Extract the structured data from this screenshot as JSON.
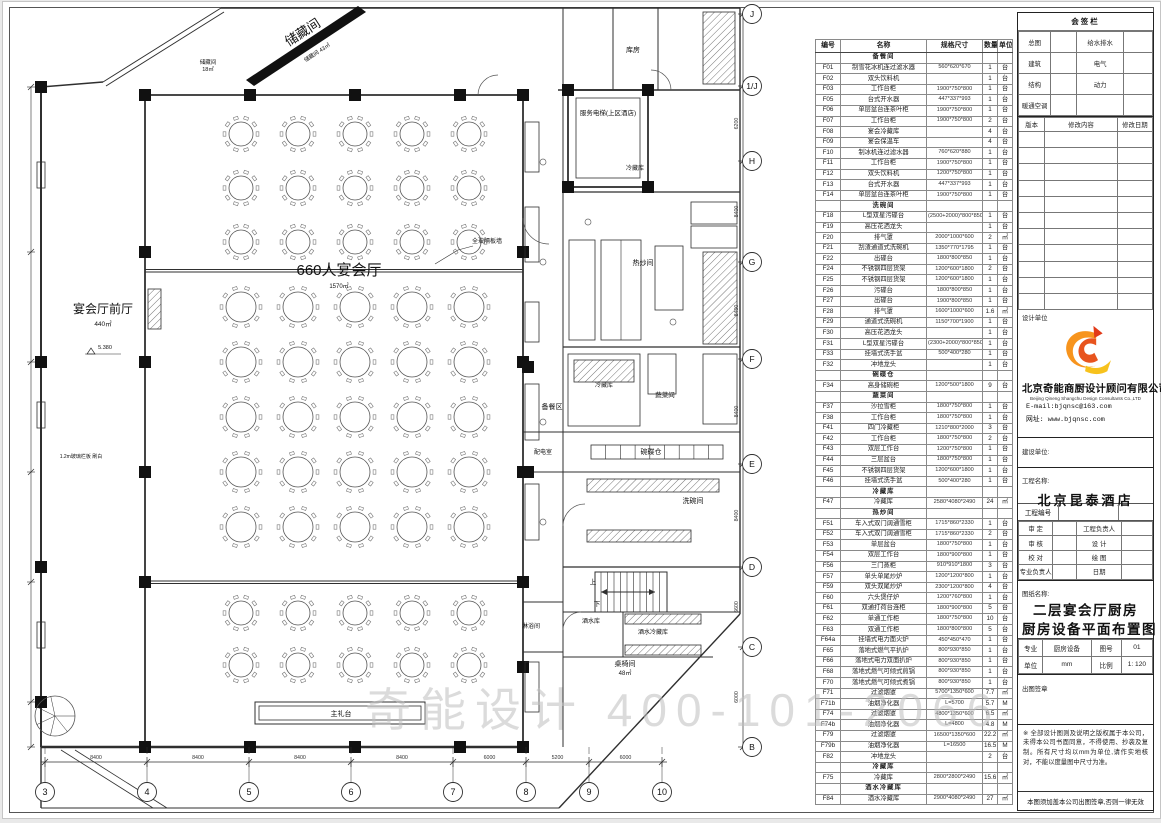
{
  "watermark": "奇能设计 400-101-2066",
  "plan": {
    "room_labels": [
      {
        "t": "宴会厅前厅",
        "x": 100,
        "y": 311,
        "s": 12
      },
      {
        "t": "440㎡",
        "x": 100,
        "y": 324,
        "s": 6.5
      },
      {
        "t": "5.380",
        "x": 102,
        "y": 347,
        "s": 5.5
      },
      {
        "t": "660人宴会厅",
        "x": 336,
        "y": 273,
        "s": 15
      },
      {
        "t": "1570㎡",
        "x": 336,
        "y": 286,
        "s": 6
      },
      {
        "t": "全玻隔板墙",
        "x": 484,
        "y": 241,
        "s": 6
      },
      {
        "t": "储藏间",
        "x": 302,
        "y": 34,
        "s": 13,
        "r": -33
      },
      {
        "t": "储藏间 43㎡",
        "x": 315,
        "y": 52,
        "s": 5.5,
        "r": -33
      },
      {
        "t": "储藏间",
        "x": 205,
        "y": 62,
        "s": 5.5
      },
      {
        "t": "18㎡",
        "x": 205,
        "y": 69,
        "s": 5.5
      },
      {
        "t": "服务电梯(上区酒店)",
        "x": 605,
        "y": 113,
        "s": 6.5
      },
      {
        "t": "库房",
        "x": 630,
        "y": 50,
        "s": 7
      },
      {
        "t": "冷藏库",
        "x": 632,
        "y": 168,
        "s": 6
      },
      {
        "t": "热炒间",
        "x": 640,
        "y": 263,
        "s": 7
      },
      {
        "t": "备餐区",
        "x": 549,
        "y": 407,
        "s": 7
      },
      {
        "t": "冷藏库",
        "x": 601,
        "y": 385,
        "s": 6
      },
      {
        "t": "蔬菜间",
        "x": 662,
        "y": 395,
        "s": 6.5
      },
      {
        "t": "碗碟仓",
        "x": 648,
        "y": 452,
        "s": 7
      },
      {
        "t": "洗碗间",
        "x": 690,
        "y": 501,
        "s": 7
      },
      {
        "t": "配电室",
        "x": 540,
        "y": 452,
        "s": 6
      },
      {
        "t": "淋浴间",
        "x": 528,
        "y": 626,
        "s": 6
      },
      {
        "t": "酒水库",
        "x": 588,
        "y": 621,
        "s": 6
      },
      {
        "t": "酒水冷藏库",
        "x": 650,
        "y": 632,
        "s": 6
      },
      {
        "t": "桌椅间",
        "x": 622,
        "y": 664,
        "s": 7
      },
      {
        "t": "48㎡",
        "x": 622,
        "y": 673,
        "s": 6
      },
      {
        "t": "主礼台",
        "x": 338,
        "y": 714,
        "s": 7
      },
      {
        "t": "上",
        "x": 590,
        "y": 582,
        "s": 6.5
      },
      {
        "t": "下",
        "x": 594,
        "y": 604,
        "s": 6.5
      },
      {
        "t": "1.2m玻璃栏板 刷白",
        "x": 78,
        "y": 456,
        "s": 5
      }
    ],
    "grid_cols": {
      "labels": [
        "3",
        "4",
        "5",
        "6",
        "7",
        "8",
        "9",
        "10"
      ],
      "x": [
        42,
        144,
        246,
        348,
        450,
        523,
        586,
        659
      ],
      "dims": [
        "8400",
        "8400",
        "8400",
        "8400",
        "6000",
        "5200",
        "6000"
      ]
    },
    "grid_rows": {
      "labels": [
        "J",
        "1/J",
        "H",
        "G",
        "F",
        "E",
        "D",
        "C",
        "B"
      ],
      "y": [
        12,
        84,
        159,
        260,
        357,
        462,
        565,
        645,
        745
      ],
      "dims": [
        "",
        "6200",
        "8400",
        "8400",
        "8400",
        "8400",
        "6600",
        "6000"
      ]
    }
  },
  "equipment_table": {
    "headers": [
      "编号",
      "名称",
      "规格尺寸",
      "数量",
      "单位"
    ],
    "rows": [
      {
        "section": "备餐间"
      },
      [
        "F01",
        "制雪花冰机连过滤水器",
        "560*620*670",
        "1",
        "台"
      ],
      [
        "F02",
        "双头饮料机",
        "",
        "1",
        "台"
      ],
      [
        "F03",
        "工作台柜",
        "1900*750*800",
        "1",
        "台"
      ],
      [
        "F05",
        "台式开水器",
        "447*337*993",
        "1",
        "台"
      ],
      [
        "F06",
        "单层盆台连茶叶柜",
        "1900*750*800",
        "1",
        "台"
      ],
      [
        "F07",
        "工作台柜",
        "1900*750*800",
        "2",
        "台"
      ],
      [
        "F08",
        "宴会冷藏库",
        "",
        "4",
        "台"
      ],
      [
        "F09",
        "宴会保温车",
        "",
        "4",
        "台"
      ],
      [
        "F10",
        "制冰机连过滤水器",
        "760*620*880",
        "1",
        "台"
      ],
      [
        "F11",
        "工作台柜",
        "1900*750*800",
        "1",
        "台"
      ],
      [
        "F12",
        "双头饮料机",
        "1200*750*800",
        "1",
        "台"
      ],
      [
        "F13",
        "台式开水器",
        "447*337*993",
        "1",
        "台"
      ],
      [
        "F14",
        "单层盆台连茶叶柜",
        "1900*750*800",
        "1",
        "台"
      ],
      {
        "section": "洗碗间"
      },
      [
        "F18",
        "L型双星污碟台",
        "(2500+2000)*800*850",
        "1",
        "台"
      ],
      [
        "F19",
        "高压花洒龙头",
        "",
        "1",
        "台"
      ],
      [
        "F20",
        "排气罩",
        "2000*1000*600",
        "2",
        "㎡"
      ],
      [
        "F21",
        "刮渣通道式洗碗机",
        "1350*770*1795",
        "1",
        "台"
      ],
      [
        "F22",
        "出碟台",
        "1800*800*850",
        "1",
        "台"
      ],
      [
        "F24",
        "不锈钢四层货架",
        "1200*600*1800",
        "2",
        "台"
      ],
      [
        "F25",
        "不锈钢四层货架",
        "1200*600*1800",
        "1",
        "台"
      ],
      [
        "F26",
        "污碟台",
        "1800*800*850",
        "1",
        "台"
      ],
      [
        "F27",
        "出碟台",
        "1900*800*850",
        "1",
        "台"
      ],
      [
        "F28",
        "排气罩",
        "1600*1000*600",
        "1.6",
        "㎡"
      ],
      [
        "F29",
        "通道式洗碗机",
        "1150*700*1900",
        "1",
        "台"
      ],
      [
        "F30",
        "高压花洒龙头",
        "",
        "1",
        "台"
      ],
      [
        "F31",
        "L型双星污碟台",
        "(2300+2000)*800*850",
        "1",
        "台"
      ],
      [
        "F33",
        "挂墙式洗手盆",
        "500*400*280",
        "1",
        "台"
      ],
      [
        "F32",
        "冲地龙头",
        "",
        "1",
        "台"
      ],
      {
        "section": "碗碟仓"
      },
      [
        "F34",
        "高身储碗柜",
        "1200*500*1800",
        "9",
        "台"
      ],
      {
        "section": "蔬菜间"
      },
      [
        "F37",
        "沙拉雪柜",
        "1800*750*800",
        "1",
        "台"
      ],
      [
        "F38",
        "工作台柜",
        "1800*750*800",
        "1",
        "台"
      ],
      [
        "F41",
        "四门冷藏柜",
        "1210*800*2000",
        "3",
        "台"
      ],
      [
        "F42",
        "工作台柜",
        "1800*750*800",
        "2",
        "台"
      ],
      [
        "F43",
        "双层工作台",
        "1200*750*800",
        "1",
        "台"
      ],
      [
        "F44",
        "三层盆台",
        "1800*750*800",
        "1",
        "台"
      ],
      [
        "F45",
        "不锈钢四层货架",
        "1200*600*1800",
        "1",
        "台"
      ],
      [
        "F46",
        "挂墙式洗手盆",
        "500*400*280",
        "1",
        "台"
      ],
      {
        "section": "冷藏库"
      },
      [
        "F47",
        "冷藏库",
        "2580*4080*2490",
        "24",
        "㎡"
      ],
      {
        "section": "热炒间"
      },
      [
        "F51",
        "车入式双门阔通雪柜",
        "1715*860*2330",
        "1",
        "台"
      ],
      [
        "F52",
        "车入式双门阔通雪柜",
        "1715*860*2330",
        "2",
        "台"
      ],
      [
        "F53",
        "单层盆台",
        "1800*750*800",
        "1",
        "台"
      ],
      [
        "F54",
        "双层工作台",
        "1800*900*800",
        "1",
        "台"
      ],
      [
        "F56",
        "三门蒸柜",
        "910*910*1800",
        "3",
        "台"
      ],
      [
        "F57",
        "单头单尾炒炉",
        "1200*1200*800",
        "1",
        "台"
      ],
      [
        "F59",
        "双头双尾炒炉",
        "2300*1200*800",
        "4",
        "台"
      ],
      [
        "F60",
        "六头煲仔炉",
        "1200*760*800",
        "1",
        "台"
      ],
      [
        "F61",
        "双通打荷台连柜",
        "1800*900*800",
        "5",
        "台"
      ],
      [
        "F62",
        "单通工作柜",
        "1800*750*800",
        "10",
        "台"
      ],
      [
        "F63",
        "双通工作柜",
        "1800*800*800",
        "5",
        "台"
      ],
      [
        "F64a",
        "挂墙式电力面火炉",
        "450*450*470",
        "1",
        "台"
      ],
      [
        "F65",
        "落地式燃气平扒炉",
        "800*930*850",
        "1",
        "台"
      ],
      [
        "F66",
        "落地式电力双面扒炉",
        "800*930*850",
        "1",
        "台"
      ],
      [
        "F68",
        "落地式燃气可倾式煎锅",
        "800*930*850",
        "1",
        "台"
      ],
      [
        "F70",
        "落地式燃气可倾式煮锅",
        "800*930*850",
        "1",
        "台"
      ],
      [
        "F71",
        "过滤烟罩",
        "5700*1350*600",
        "7.7",
        "㎡"
      ],
      [
        "F71b",
        "油烟净化器",
        "L=5700",
        "5.7",
        "M"
      ],
      [
        "F74",
        "过滤烟罩",
        "4800*1350*600",
        "6.5",
        "㎡"
      ],
      [
        "F74b",
        "油烟净化器",
        "L=4800",
        "4.8",
        "M"
      ],
      [
        "F79",
        "过滤烟罩",
        "16500*1350*600",
        "22.2",
        "㎡"
      ],
      [
        "F79b",
        "油烟净化器",
        "L=16500",
        "16.5",
        "M"
      ],
      [
        "F82",
        "冲地龙头",
        "",
        "2",
        "台"
      ],
      {
        "section": "冷藏库"
      },
      [
        "F75",
        "冷藏库",
        "2800*2800*2490",
        "15.6",
        "㎡"
      ],
      {
        "section": "酒水冷藏库"
      },
      [
        "F84",
        "酒水冷藏库",
        "2900*4080*2490",
        "27",
        "㎡"
      ]
    ]
  },
  "panel": {
    "sig_title": "会签栏",
    "sig_rows": [
      [
        "总图",
        "",
        "给水排水",
        ""
      ],
      [
        "建筑",
        "",
        "电气",
        ""
      ],
      [
        "结构",
        "",
        "动力",
        ""
      ],
      [
        "暖通空调",
        "",
        "",
        ""
      ]
    ],
    "rev_headers": [
      "版本",
      "修改内容",
      "修改日期"
    ],
    "design_firm_label": "设计单位",
    "company_cn": "北京奇能商厨设计顾问有限公司",
    "company_en": "Beijing Qineng Shangchu Design Consultants Co.,LTD",
    "email": "E-mail:bjqnsc@163.com",
    "website": "网址: www.bjqnsc.com",
    "client_label": "建设单位:",
    "project_label": "工程名称:",
    "project_name": "北京昆泰酒店",
    "project_no_label": "工程编号",
    "approval_rows": [
      [
        "审 定",
        "",
        "工程负责人",
        ""
      ],
      [
        "审 核",
        "",
        "设 计",
        ""
      ],
      [
        "校 对",
        "",
        "绘 图",
        ""
      ],
      [
        "专业负责人",
        "",
        "日期",
        ""
      ]
    ],
    "sheet_title_label": "图纸名称:",
    "drawing_title_line1": "二层宴会厅厨房",
    "drawing_title_line2": "厨房设备平面布置图",
    "meta_rows": [
      [
        "专业",
        "厨房设备",
        "图号",
        "01"
      ],
      [
        "单位",
        "mm",
        "比例",
        "1: 120"
      ]
    ],
    "stamp_label": "出图签章",
    "copyright_note": "※ 全部设计图则及说明之版权属于本公司，未得本公司书面同意，不得使用、抄袭及复制。所有尺寸均以mm为单位,请作实地核对，不能以度量图中尺寸为准。",
    "validity_note": "本图须加盖本公司出图签章,否则一律无效"
  }
}
